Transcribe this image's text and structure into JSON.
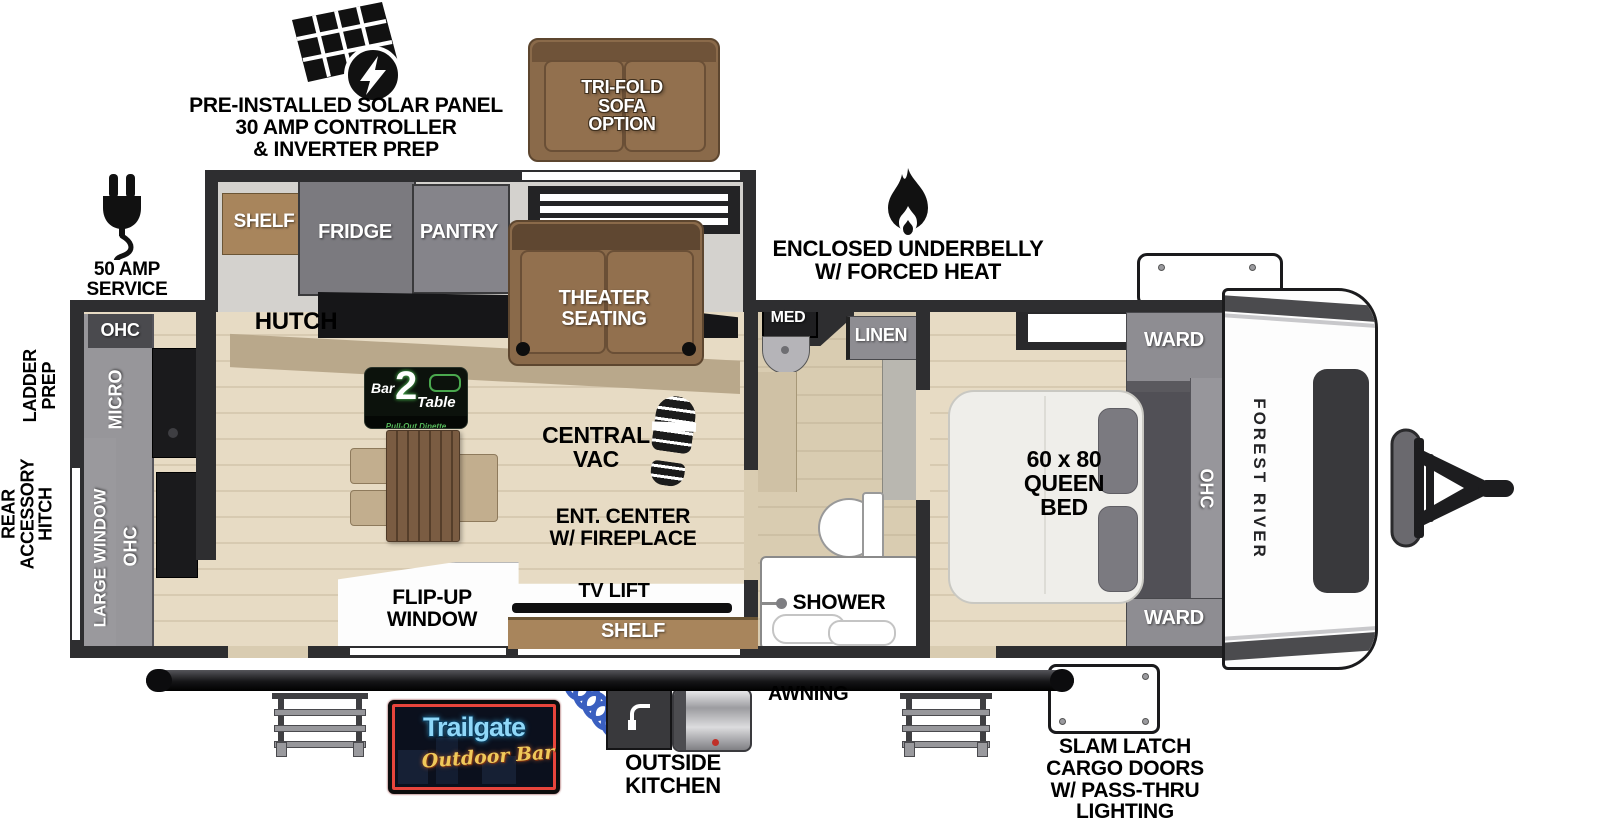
{
  "palette": {
    "wall": "#2e2e30",
    "floor_wood": "#e7dbc4",
    "floor_tan": "#d9ccb1",
    "cabinet_gray": "#8e8d92",
    "furniture_brown": "#8a6a4a",
    "shelf_brown": "#a8855c",
    "logo_green": "#4aa84e",
    "neon_blue": "#8fd8f8",
    "neon_gold": "#f0c95a",
    "neon_red": "#ff4f4a"
  },
  "icons": {
    "solar_panel": "solar-panel-with-lightning-badge",
    "power_plug": "power-plug-with-cord",
    "flame": "flame",
    "boot_print": "boot-print",
    "coil_hose": "blue-coiled-hose",
    "hitch": "a-frame-tongue-hitch"
  },
  "callouts": {
    "solar": {
      "lines": [
        "PRE-INSTALLED SOLAR PANEL",
        "30 AMP CONTROLLER",
        "& INVERTER PREP"
      ]
    },
    "amp_service": "50 AMP SERVICE",
    "ladder_prep": {
      "lines": [
        "LADDER",
        "PREP"
      ]
    },
    "rear_accessory_hitch": {
      "lines": [
        "REAR",
        "ACCESSORY",
        "HITCH"
      ]
    },
    "underbelly": {
      "lines": [
        "ENCLOSED UNDERBELLY",
        "W/ FORCED HEAT"
      ]
    },
    "awning": "AWNING",
    "outside_kitchen": {
      "lines": [
        "OUTSIDE",
        "KITCHEN"
      ]
    },
    "slam_latch": {
      "lines": [
        "SLAM LATCH",
        "CARGO DOORS",
        "W/ PASS-THRU",
        "LIGHTING"
      ]
    },
    "trifold_sofa": {
      "lines": [
        "TRI-FOLD",
        "SOFA",
        "OPTION"
      ]
    }
  },
  "galley": {
    "ohc_top": "OHC",
    "micro": "MICRO",
    "large_window": "LARGE WINDOW",
    "ohc_side": "OHC",
    "shelf": "SHELF",
    "fridge": "FRIDGE",
    "pantry": "PANTRY",
    "hutch": "HUTCH"
  },
  "living": {
    "theater": {
      "lines": [
        "THEATER",
        "SEATING"
      ]
    },
    "central_vac": {
      "lines": [
        "CENTRAL",
        "VAC"
      ]
    },
    "ent_center": {
      "lines": [
        "ENT. CENTER",
        "W/ FIREPLACE"
      ]
    },
    "tv_lift": "TV LIFT",
    "shelf": "SHELF",
    "flip_up_window": {
      "lines": [
        "FLIP-UP",
        "WINDOW"
      ]
    }
  },
  "bath": {
    "med": "MED",
    "linen": "LINEN",
    "shower": "SHOWER"
  },
  "bedroom": {
    "ward_top": "WARD",
    "ward_bottom": "WARD",
    "ohc": "OHC",
    "bed": {
      "lines": [
        "60 x 80",
        "QUEEN",
        "BED"
      ]
    }
  },
  "branding": {
    "forest_river": "FOREST RIVER",
    "bar2table": {
      "bar": "Bar",
      "two": "2",
      "table": "Table",
      "tagline": "Pull-Out Dinette"
    },
    "trailgate": {
      "name": "Trailgate",
      "sub": "Outdoor Bar"
    }
  }
}
